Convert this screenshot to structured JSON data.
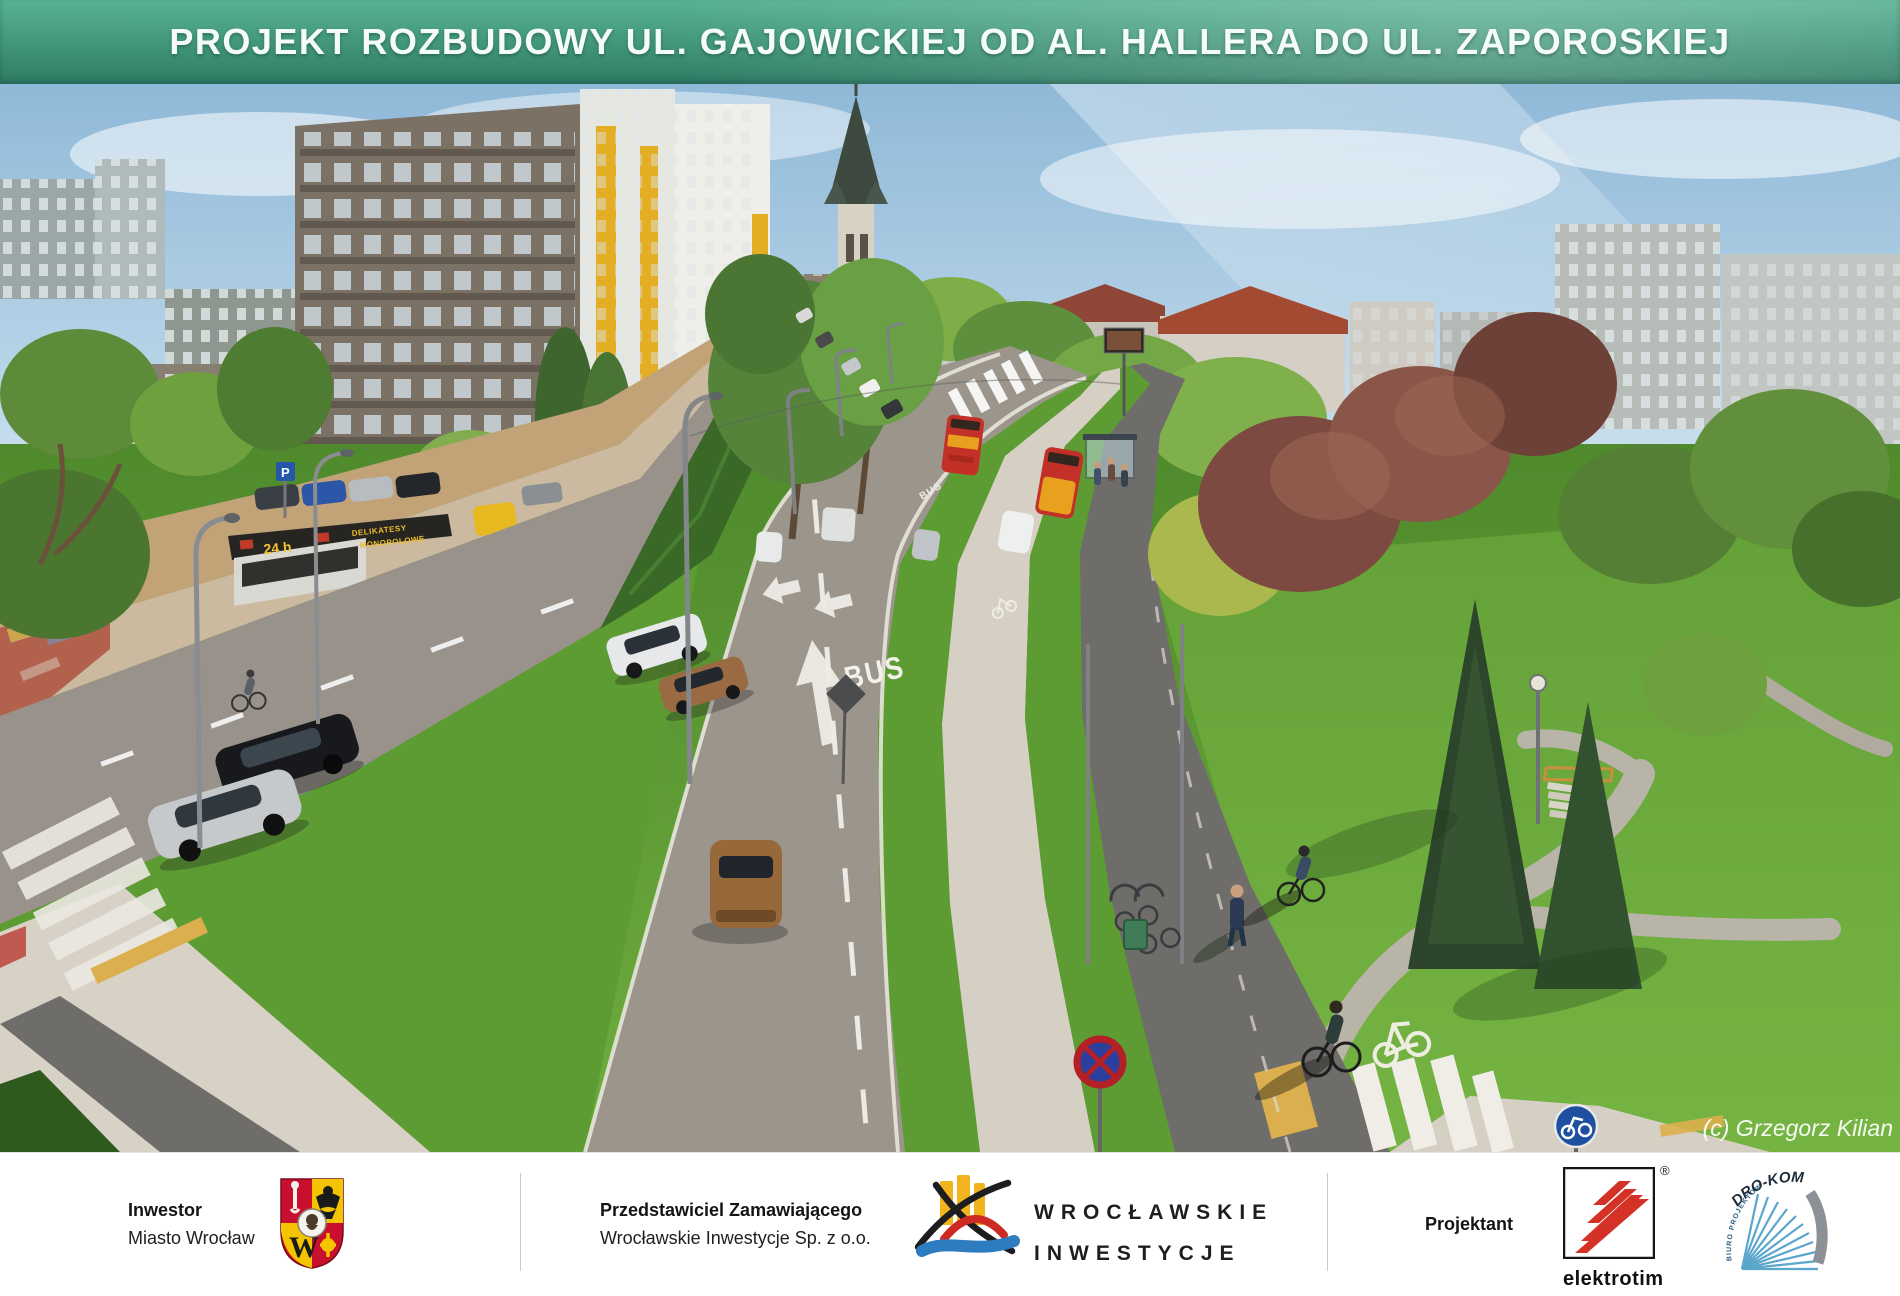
{
  "header": {
    "title": "PROJEKT ROZBUDOWY UL. GAJOWICKIEJ OD AL. HALLERA DO UL. ZAPOROSKIEJ"
  },
  "scene": {
    "credit": "(c) Grzegorz Kilian",
    "markings": {
      "bus_near": "BUS",
      "bus_far": "BUS"
    },
    "kiosk": {
      "hours": "24 h",
      "sign_top": "DELIKATESY",
      "sign_bottom": "MONOPOLOWE"
    },
    "signs": {
      "parking": "P"
    },
    "palette": {
      "banner_green_top": "#58b294",
      "banner_green_bottom": "#2d7c64",
      "sky": "#9cc3dd",
      "grass": "#5d9c33",
      "asphalt": "#9b958b",
      "bike_path": "#6e6d6a",
      "sidewalk": "#d6d0c4",
      "bus_red": "#c23028",
      "bus_yellow": "#e8a11e",
      "marking_white": "#f2f1ec",
      "tactile_yellow": "#dcaf4e",
      "hedge_green": "#3a6827",
      "red_tree": "#7c4a40"
    }
  },
  "footer": {
    "investor": {
      "label": "Inwestor",
      "value": "Miasto Wrocław",
      "crest_letter": "W"
    },
    "representative": {
      "label": "Przedstawiciel Zamawiającego",
      "value": "Wrocławskie Inwestycje  Sp. z o.o."
    },
    "wi_logo": {
      "line1": "WROCŁAWSKIE",
      "line2": "INWESTYCJE"
    },
    "designer": {
      "label": "Projektant"
    },
    "elektrotim": {
      "name": "elektrotim",
      "registered": "®"
    },
    "drokom": {
      "name": "DRO-KOM",
      "subtitle": "BIURO PROJEKTOWE"
    }
  }
}
